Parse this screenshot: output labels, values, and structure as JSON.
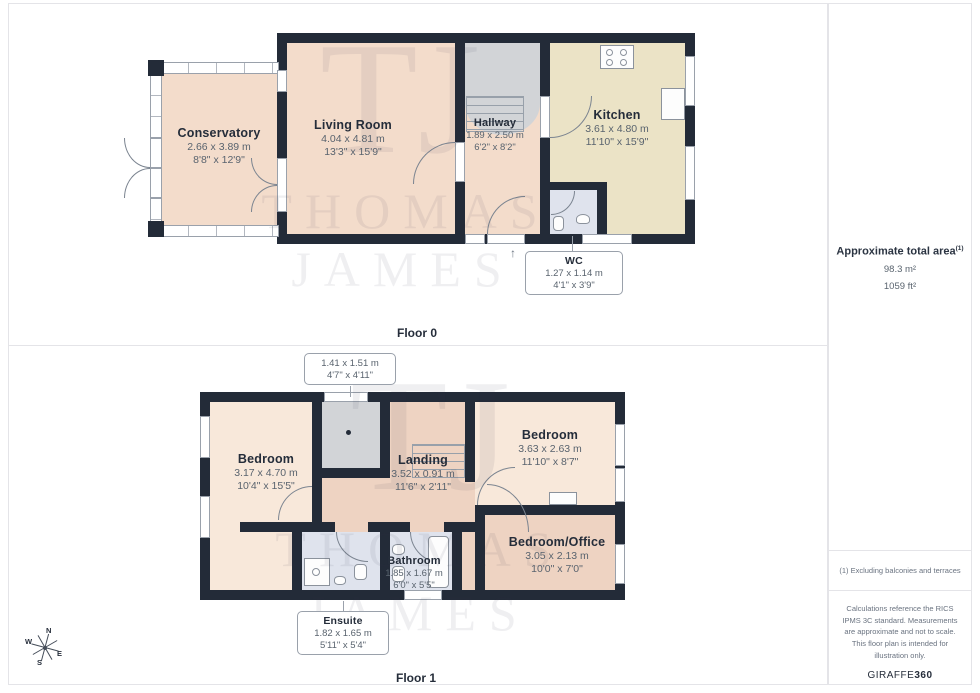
{
  "page": {
    "floor0_label": "Floor 0",
    "floor1_label": "Floor 1",
    "entrance_arrow": "↑"
  },
  "rooms": {
    "conservatory": {
      "name": "Conservatory",
      "m": "2.66 x 3.89 m",
      "ft": "8'8\" x 12'9\""
    },
    "living": {
      "name": "Living Room",
      "m": "4.04 x 4.81 m",
      "ft": "13'3\" x 15'9\""
    },
    "hallway": {
      "name": "Hallway",
      "m": "1.89 x 2.50 m",
      "ft": "6'2\" x 8'2\""
    },
    "kitchen": {
      "name": "Kitchen",
      "m": "3.61 x 4.80 m",
      "ft": "11'10\" x 15'9\""
    },
    "wc": {
      "name": "WC",
      "m": "1.27 x 1.14 m",
      "ft": "4'1\" x 3'9\""
    },
    "bedroom1": {
      "name": "Bedroom",
      "m": "3.17 x 4.70 m",
      "ft": "10'4\" x 15'5\""
    },
    "landing": {
      "name": "Landing",
      "m": "3.52 x 0.91 m",
      "ft": "11'6\" x 2'11\""
    },
    "bedroom2": {
      "name": "Bedroom",
      "m": "3.63 x 2.63 m",
      "ft": "11'10\" x 8'7\""
    },
    "office": {
      "name": "Bedroom/Office",
      "m": "3.05 x 2.13 m",
      "ft": "10'0\" x 7'0\""
    },
    "bathroom": {
      "name": "Bathroom",
      "m": "1.85 x 1.67 m",
      "ft": "6'0\" x 5'5\""
    },
    "ensuite": {
      "name": "Ensuite",
      "m": "1.82 x 1.65 m",
      "ft": "5'11\" x 5'4\""
    },
    "stairs_callout": {
      "m": "1.41 x 1.51 m",
      "ft": "4'7\" x 4'11\""
    }
  },
  "sidebar": {
    "area_title": "Approximate total area",
    "area_sup": "(1)",
    "area_m2": "98.3 m²",
    "area_ft2": "1059 ft²",
    "note": "(1) Excluding balconies and terraces",
    "disclaimer": "Calculations reference the RICS IPMS 3C standard. Measurements are approximate and not to scale. This floor plan is intended for illustration only.",
    "brand_name": "GIRAFFE",
    "brand_suffix": "360"
  },
  "compass": {
    "n": "N",
    "e": "E",
    "s": "S",
    "w": "W"
  },
  "watermark": {
    "monogram": "TJ",
    "word1": "THOMAS",
    "word2": "JAMES"
  },
  "colors": {
    "wall": "#232b38",
    "floor0_room": "#f3dccb",
    "kitchen": "#ebe3c6",
    "wet": "#dfe3ed",
    "bedroom": "#f8e8da",
    "landing": "#eed3c2",
    "stairs": "#d2d4d7"
  }
}
